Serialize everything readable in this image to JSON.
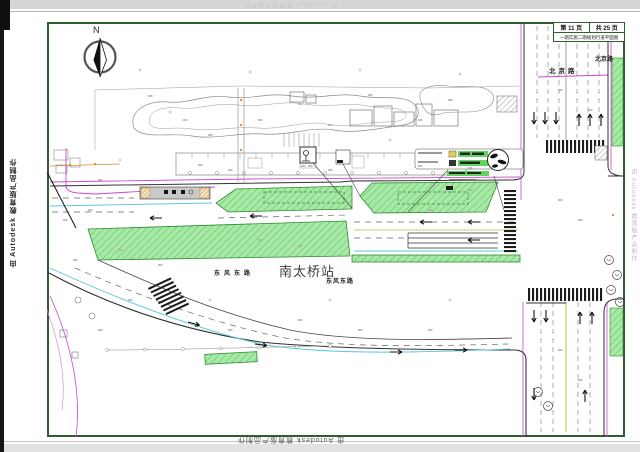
{
  "watermarks": {
    "left": "由 Autodesk 教育版产品制作",
    "top": "由 Autodesk 教育版产品制作",
    "bottom": "由 Autodesk 教育版产品制作",
    "right": "由 Autodesk 教育版产品制作"
  },
  "title_block": {
    "page": "第 11 页",
    "total": "共 25 页",
    "title": "一期实施二期规划行道平面图"
  },
  "compass_label": "N",
  "labels": {
    "station": "南太桥站",
    "road_dongfeng_west": "东风东路",
    "road_dongfeng_east": "东风东路",
    "road_beijing": "北京路",
    "road_beijing_upper": "北京路"
  },
  "colors": {
    "frame": "#2d5f2d",
    "green_fill": "#a9e8a9",
    "green_hatch": "#63cf63",
    "green_border": "#2e8b2e",
    "magenta": "#cc44cc",
    "cyan": "#57c8d8",
    "orange": "#d08a2e",
    "yellow": "#d2c45e",
    "highlight_green": "#5fd45f"
  }
}
